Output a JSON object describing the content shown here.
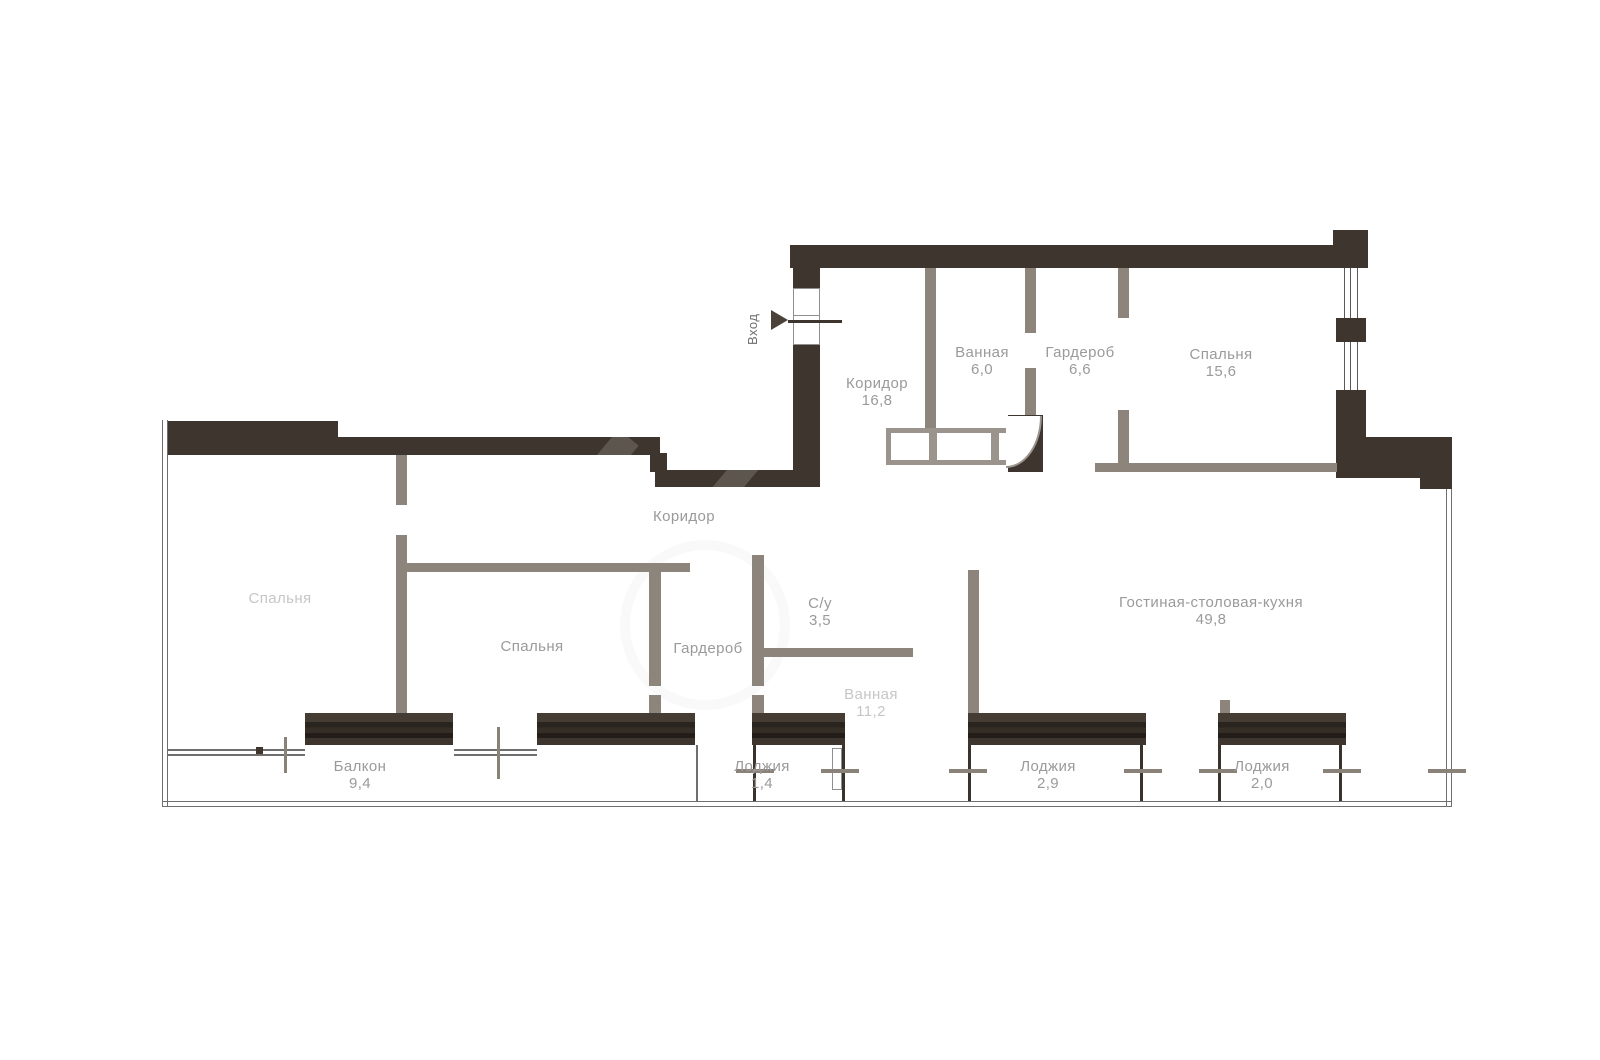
{
  "plan": {
    "entrance_label": "Вход",
    "rooms": [
      {
        "name": "Коридор",
        "area": "16,8"
      },
      {
        "name": "Ванная",
        "area": "6,0"
      },
      {
        "name": "Гардероб",
        "area": "6,6"
      },
      {
        "name": "Спальня",
        "area": "15,6"
      },
      {
        "name": "Коридор",
        "area": ""
      },
      {
        "name": "Спальня",
        "area": ""
      },
      {
        "name": "Спальня",
        "area": ""
      },
      {
        "name": "Гардероб",
        "area": ""
      },
      {
        "name": "С/у",
        "area": "3,5"
      },
      {
        "name": "Ванная",
        "area": "11,2"
      },
      {
        "name": "Гостиная-столовая-кухня",
        "area": "49,8"
      },
      {
        "name": "Балкон",
        "area": "9,4"
      },
      {
        "name": "Лоджия",
        "area": "1,4"
      },
      {
        "name": "Лоджия",
        "area": "2,9"
      },
      {
        "name": "Лоджия",
        "area": "2,0"
      }
    ],
    "colors": {
      "wall_dark": "#3e362e",
      "wall_gray": "#8d857c",
      "label_text": "#9a9a9a",
      "label_faded": "#c6c6c6",
      "boundary_line": "#6f6f6f"
    }
  }
}
